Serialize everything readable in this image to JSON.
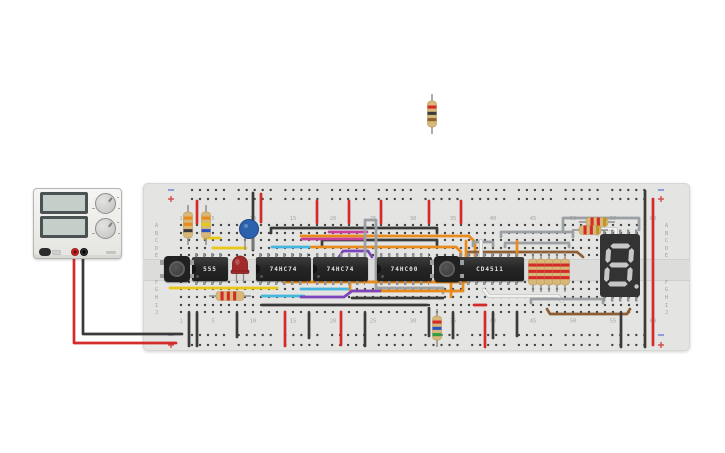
{
  "canvas": {
    "width": 725,
    "height": 453,
    "background": "#ffffff"
  },
  "power_supply": {
    "voltage_display_value": "",
    "current_display_value": "",
    "terminals": [
      "red-positive",
      "black-negative"
    ]
  },
  "breadboard": {
    "col_labels": [
      "1",
      "5",
      "10",
      "15",
      "20",
      "25",
      "30",
      "35",
      "40",
      "45",
      "50",
      "55",
      "60"
    ],
    "col_label_cols": [
      1,
      5,
      10,
      15,
      20,
      25,
      30,
      35,
      40,
      45,
      50,
      55,
      60
    ],
    "row_labels": [
      "A",
      "B",
      "C",
      "D",
      "E",
      "F",
      "G",
      "H",
      "I",
      "J"
    ],
    "rail_minus": "−",
    "rail_plus": "+"
  },
  "ics": [
    {
      "label": "555",
      "pins_per_side": 4
    },
    {
      "label": "74HC74",
      "pins_per_side": 7
    },
    {
      "label": "74HC74",
      "pins_per_side": 7
    },
    {
      "label": "74HC00",
      "pins_per_side": 7
    },
    {
      "label": "CD4511",
      "pins_per_side": 8
    }
  ],
  "seven_segment": {
    "digit": "8",
    "decimal_point": true,
    "body_color": "#333333",
    "segment_color": "#c7c7c7",
    "x": 600,
    "y": 234,
    "w": 40,
    "h": 63
  },
  "colors": {
    "red": "#d42a2a",
    "black": "#3a3a3a",
    "gray": "#9aa0a4",
    "white": "#f2f2f0",
    "yellow": "#e9c716",
    "cyan": "#45b6e0",
    "magenta": "#c93f9e",
    "purple": "#7c44bd",
    "orange": "#e98b1c",
    "brown": "#8e5f34",
    "blue": "#2b52c4",
    "green": "#2f9e44",
    "gold": "#c09526",
    "resistor_body": "#d8b879"
  },
  "wires": [
    {
      "c": "red",
      "p": [
        [
          74,
          251
        ],
        [
          74,
          343
        ],
        [
          176,
          343
        ]
      ]
    },
    {
      "c": "black",
      "p": [
        [
          83,
          251
        ],
        [
          83,
          334
        ],
        [
          182,
          334
        ]
      ]
    },
    {
      "c": "red",
      "p": [
        [
          197,
          201
        ],
        [
          197,
          223
        ]
      ]
    },
    {
      "c": "red",
      "p": [
        [
          317,
          201
        ],
        [
          317,
          223
        ]
      ]
    },
    {
      "c": "red",
      "p": [
        [
          349,
          201
        ],
        [
          349,
          223
        ]
      ]
    },
    {
      "c": "red",
      "p": [
        [
          381,
          201
        ],
        [
          381,
          223
        ]
      ]
    },
    {
      "c": "red",
      "p": [
        [
          429,
          201
        ],
        [
          429,
          223
        ]
      ]
    },
    {
      "c": "red",
      "p": [
        [
          461,
          201
        ],
        [
          461,
          223
        ]
      ]
    },
    {
      "c": "black",
      "p": [
        [
          645,
          191
        ],
        [
          645,
          347
        ]
      ]
    },
    {
      "c": "red",
      "p": [
        [
          653,
          199
        ],
        [
          653,
          345
        ]
      ]
    },
    {
      "c": "black",
      "p": [
        [
          253,
          193
        ],
        [
          253,
          250
        ]
      ]
    },
    {
      "c": "red",
      "p": [
        [
          261,
          194
        ],
        [
          261,
          222
        ]
      ]
    },
    {
      "c": "black",
      "p": [
        [
          271,
          233
        ],
        [
          271,
          228
        ],
        [
          437,
          228
        ],
        [
          437,
          233
        ]
      ]
    },
    {
      "c": "black",
      "p": [
        [
          322,
          245
        ],
        [
          322,
          240
        ],
        [
          437,
          240
        ],
        [
          437,
          245
        ]
      ]
    },
    {
      "c": "magenta",
      "p": [
        [
          329,
          232
        ],
        [
          367,
          232
        ]
      ]
    },
    {
      "c": "magenta",
      "p": [
        [
          302,
          239
        ],
        [
          365,
          239
        ]
      ]
    },
    {
      "c": "orange",
      "p": [
        [
          301,
          236
        ],
        [
          469,
          236
        ],
        [
          475,
          242
        ],
        [
          475,
          256
        ]
      ]
    },
    {
      "c": "orange",
      "p": [
        [
          311,
          247
        ],
        [
          456,
          247
        ],
        [
          461,
          252
        ],
        [
          461,
          256
        ]
      ]
    },
    {
      "c": "cyan",
      "p": [
        [
          272,
          247
        ],
        [
          309,
          247
        ]
      ]
    },
    {
      "c": "purple",
      "p": [
        [
          339,
          257
        ],
        [
          343,
          251
        ],
        [
          368,
          251
        ],
        [
          372,
          257
        ]
      ]
    },
    {
      "c": "gray",
      "p": [
        [
          365,
          256
        ],
        [
          365,
          220
        ],
        [
          376,
          220
        ],
        [
          376,
          288
        ],
        [
          443,
          288
        ],
        [
          443,
          293
        ]
      ]
    },
    {
      "c": "yellow",
      "p": [
        [
          204,
          238
        ],
        [
          220,
          238
        ]
      ]
    },
    {
      "c": "yellow",
      "p": [
        [
          213,
          248
        ],
        [
          246,
          248
        ]
      ]
    },
    {
      "c": "brown",
      "p": [
        [
          467,
          252
        ],
        [
          577,
          252
        ],
        [
          583,
          257
        ]
      ]
    },
    {
      "c": "gray",
      "p": [
        [
          473,
          246
        ],
        [
          473,
          242
        ],
        [
          493,
          242
        ],
        [
          493,
          246
        ]
      ]
    },
    {
      "c": "gray",
      "p": [
        [
          501,
          237
        ],
        [
          501,
          232
        ],
        [
          573,
          232
        ],
        [
          573,
          237
        ]
      ]
    },
    {
      "c": "gray",
      "p": [
        [
          505,
          247
        ],
        [
          505,
          243
        ],
        [
          569,
          243
        ],
        [
          569,
          247
        ]
      ]
    },
    {
      "c": "gray",
      "p": [
        [
          563,
          231
        ],
        [
          563,
          218
        ],
        [
          639,
          218
        ],
        [
          639,
          230
        ]
      ]
    },
    {
      "c": "white",
      "p": [
        [
          597,
          234
        ],
        [
          597,
          229
        ],
        [
          616,
          229
        ],
        [
          616,
          236
        ]
      ]
    },
    {
      "c": "white",
      "p": [
        [
          481,
          241
        ],
        [
          481,
          257
        ]
      ]
    },
    {
      "c": "orange",
      "p": [
        [
          466,
          241
        ],
        [
          466,
          257
        ]
      ]
    },
    {
      "c": "orange",
      "p": [
        [
          517,
          241
        ],
        [
          517,
          256
        ]
      ]
    },
    {
      "c": "yellow",
      "p": [
        [
          170,
          288
        ],
        [
          277,
          288
        ]
      ]
    },
    {
      "c": "orange",
      "p": [
        [
          283,
          282
        ],
        [
          466,
          282
        ],
        [
          471,
          277
        ]
      ]
    },
    {
      "c": "orange",
      "p": [
        [
          350,
          282
        ],
        [
          350,
          291
        ],
        [
          463,
          291
        ],
        [
          463,
          281
        ]
      ]
    },
    {
      "c": "cyan",
      "p": [
        [
          262,
          296
        ],
        [
          304,
          296
        ]
      ]
    },
    {
      "c": "cyan",
      "p": [
        [
          301,
          289
        ],
        [
          348,
          289
        ]
      ]
    },
    {
      "c": "purple",
      "p": [
        [
          301,
          297
        ],
        [
          344,
          297
        ],
        [
          352,
          291
        ],
        [
          380,
          291
        ]
      ]
    },
    {
      "c": "black",
      "p": [
        [
          352,
          298
        ],
        [
          443,
          298
        ]
      ]
    },
    {
      "c": "black",
      "p": [
        [
          262,
          305
        ],
        [
          427,
          305
        ]
      ]
    },
    {
      "c": "orange",
      "p": [
        [
          451,
          278
        ],
        [
          451,
          297
        ]
      ]
    },
    {
      "c": "white",
      "p": [
        [
          484,
          290
        ],
        [
          489,
          296
        ],
        [
          558,
          296
        ],
        [
          562,
          301
        ]
      ]
    },
    {
      "c": "gray",
      "p": [
        [
          531,
          303
        ],
        [
          531,
          299
        ],
        [
          603,
          299
        ],
        [
          603,
          303
        ]
      ]
    },
    {
      "c": "brown",
      "p": [
        [
          547,
          309
        ],
        [
          550,
          314
        ],
        [
          627,
          314
        ],
        [
          630,
          309
        ]
      ]
    },
    {
      "c": "black",
      "p": [
        [
          189,
          313
        ],
        [
          189,
          346
        ]
      ]
    },
    {
      "c": "black",
      "p": [
        [
          197,
          313
        ],
        [
          197,
          346
        ]
      ]
    },
    {
      "c": "black",
      "p": [
        [
          237,
          313
        ],
        [
          237,
          337
        ]
      ]
    },
    {
      "c": "red",
      "p": [
        [
          285,
          312
        ],
        [
          285,
          346
        ]
      ]
    },
    {
      "c": "black",
      "p": [
        [
          309,
          313
        ],
        [
          309,
          338
        ]
      ]
    },
    {
      "c": "red",
      "p": [
        [
          341,
          312
        ],
        [
          341,
          345
        ]
      ]
    },
    {
      "c": "black",
      "p": [
        [
          365,
          313
        ],
        [
          365,
          346
        ]
      ]
    },
    {
      "c": "black",
      "p": [
        [
          429,
          308
        ],
        [
          429,
          336
        ]
      ]
    },
    {
      "c": "black",
      "p": [
        [
          453,
          313
        ],
        [
          453,
          338
        ]
      ]
    },
    {
      "c": "red",
      "p": [
        [
          485,
          312
        ],
        [
          485,
          347
        ]
      ]
    },
    {
      "c": "red",
      "p": [
        [
          474,
          305
        ],
        [
          486,
          305
        ]
      ]
    },
    {
      "c": "black",
      "p": [
        [
          493,
          313
        ],
        [
          493,
          338
        ]
      ]
    },
    {
      "c": "black",
      "p": [
        [
          517,
          312
        ],
        [
          517,
          336
        ]
      ]
    },
    {
      "c": "black",
      "p": [
        [
          621,
          313
        ],
        [
          621,
          347
        ]
      ]
    }
  ],
  "resistors": [
    {
      "cx": 432,
      "cy": 114,
      "o": "v",
      "len": 26,
      "bands": [
        "red",
        "black",
        "brown"
      ]
    },
    {
      "cx": 188,
      "cy": 225,
      "o": "v",
      "len": 26,
      "bands": [
        "orange",
        "orange",
        "black"
      ]
    },
    {
      "cx": 206,
      "cy": 225,
      "o": "v",
      "len": 26,
      "bands": [
        "orange",
        "yellow",
        "blue"
      ]
    },
    {
      "cx": 230,
      "cy": 296,
      "o": "h",
      "len": 28,
      "bands": [
        "red",
        "red",
        "red"
      ]
    },
    {
      "cx": 437,
      "cy": 328,
      "o": "v",
      "len": 24,
      "bands": [
        "red",
        "blue",
        "green"
      ]
    },
    {
      "cx": 533,
      "cy": 272,
      "o": "v",
      "len": 26,
      "bands": [
        "red",
        "red",
        "red"
      ]
    },
    {
      "cx": 541,
      "cy": 272,
      "o": "v",
      "len": 26,
      "bands": [
        "red",
        "red",
        "red"
      ]
    },
    {
      "cx": 549,
      "cy": 272,
      "o": "v",
      "len": 26,
      "bands": [
        "red",
        "red",
        "red"
      ]
    },
    {
      "cx": 557,
      "cy": 272,
      "o": "v",
      "len": 26,
      "bands": [
        "red",
        "red",
        "red"
      ]
    },
    {
      "cx": 565,
      "cy": 272,
      "o": "v",
      "len": 26,
      "bands": [
        "red",
        "red",
        "red"
      ]
    },
    {
      "cx": 597,
      "cy": 222,
      "o": "h",
      "len": 22,
      "bands": [
        "red",
        "red",
        "gold"
      ]
    },
    {
      "cx": 590,
      "cy": 230,
      "o": "h",
      "len": 22,
      "bands": [
        "red",
        "red",
        "gold"
      ]
    }
  ],
  "led": {
    "cx": 240,
    "dome_top": 256,
    "base_y": 271,
    "color": "#a32a2a"
  },
  "capacitor": {
    "cx": 249,
    "cy": 229,
    "r": 9.5,
    "color": "#2b62ad"
  }
}
